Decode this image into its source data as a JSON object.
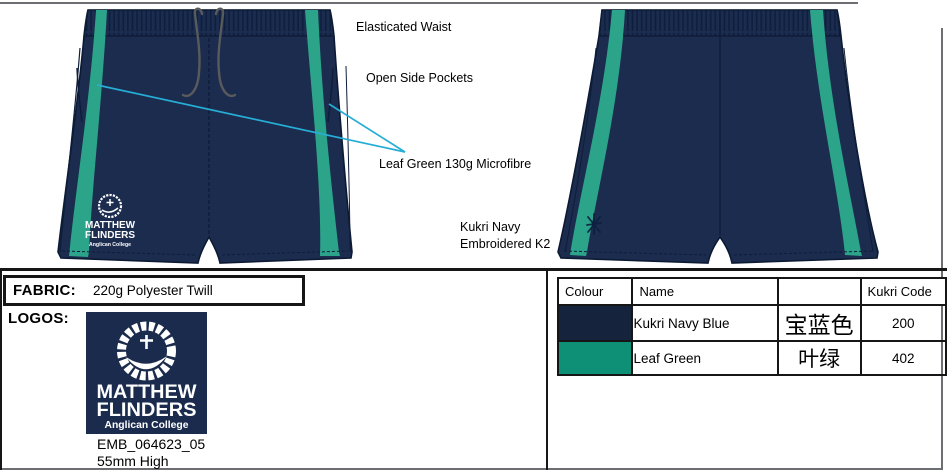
{
  "annotations": {
    "elasticated_waist": "Elasticated Waist",
    "open_side_pockets": "Open Side Pockets",
    "leaf_green_fabric": "Leaf Green 130g Microfibre",
    "kukri_navy_line1": "Kukri Navy",
    "kukri_navy_line2": "Embroidered K2"
  },
  "fabric": {
    "label": "FABRIC:",
    "value": "220g Polyester Twill"
  },
  "logos": {
    "label": "LOGOS:",
    "emb_code": "EMB_064623_05",
    "height_note": "55mm High"
  },
  "college_logo": {
    "line1": "MATTHEW",
    "line2": "FLINDERS",
    "line3": "Anglican College"
  },
  "color_table": {
    "headers": [
      "Colour",
      "Name",
      "",
      "Kukri Code"
    ],
    "rows": [
      {
        "colour_hex": "#16233C",
        "name": "Kukri Navy Blue",
        "chinese_name": "宝蓝色",
        "kukri_code": "200"
      },
      {
        "colour_hex": "#0E9076",
        "name": "Leaf Green",
        "chinese_name": "叶绿",
        "kukri_code": "402"
      }
    ]
  },
  "palette": {
    "shorts_navy": "#1B2C4F",
    "outline_navy": "#0C1A33",
    "stripe_green": "#2CA489",
    "callout_cyan": "#27AED6",
    "drawstring_grey": "#595A5C",
    "logo_navy": "#1B2B4D"
  }
}
